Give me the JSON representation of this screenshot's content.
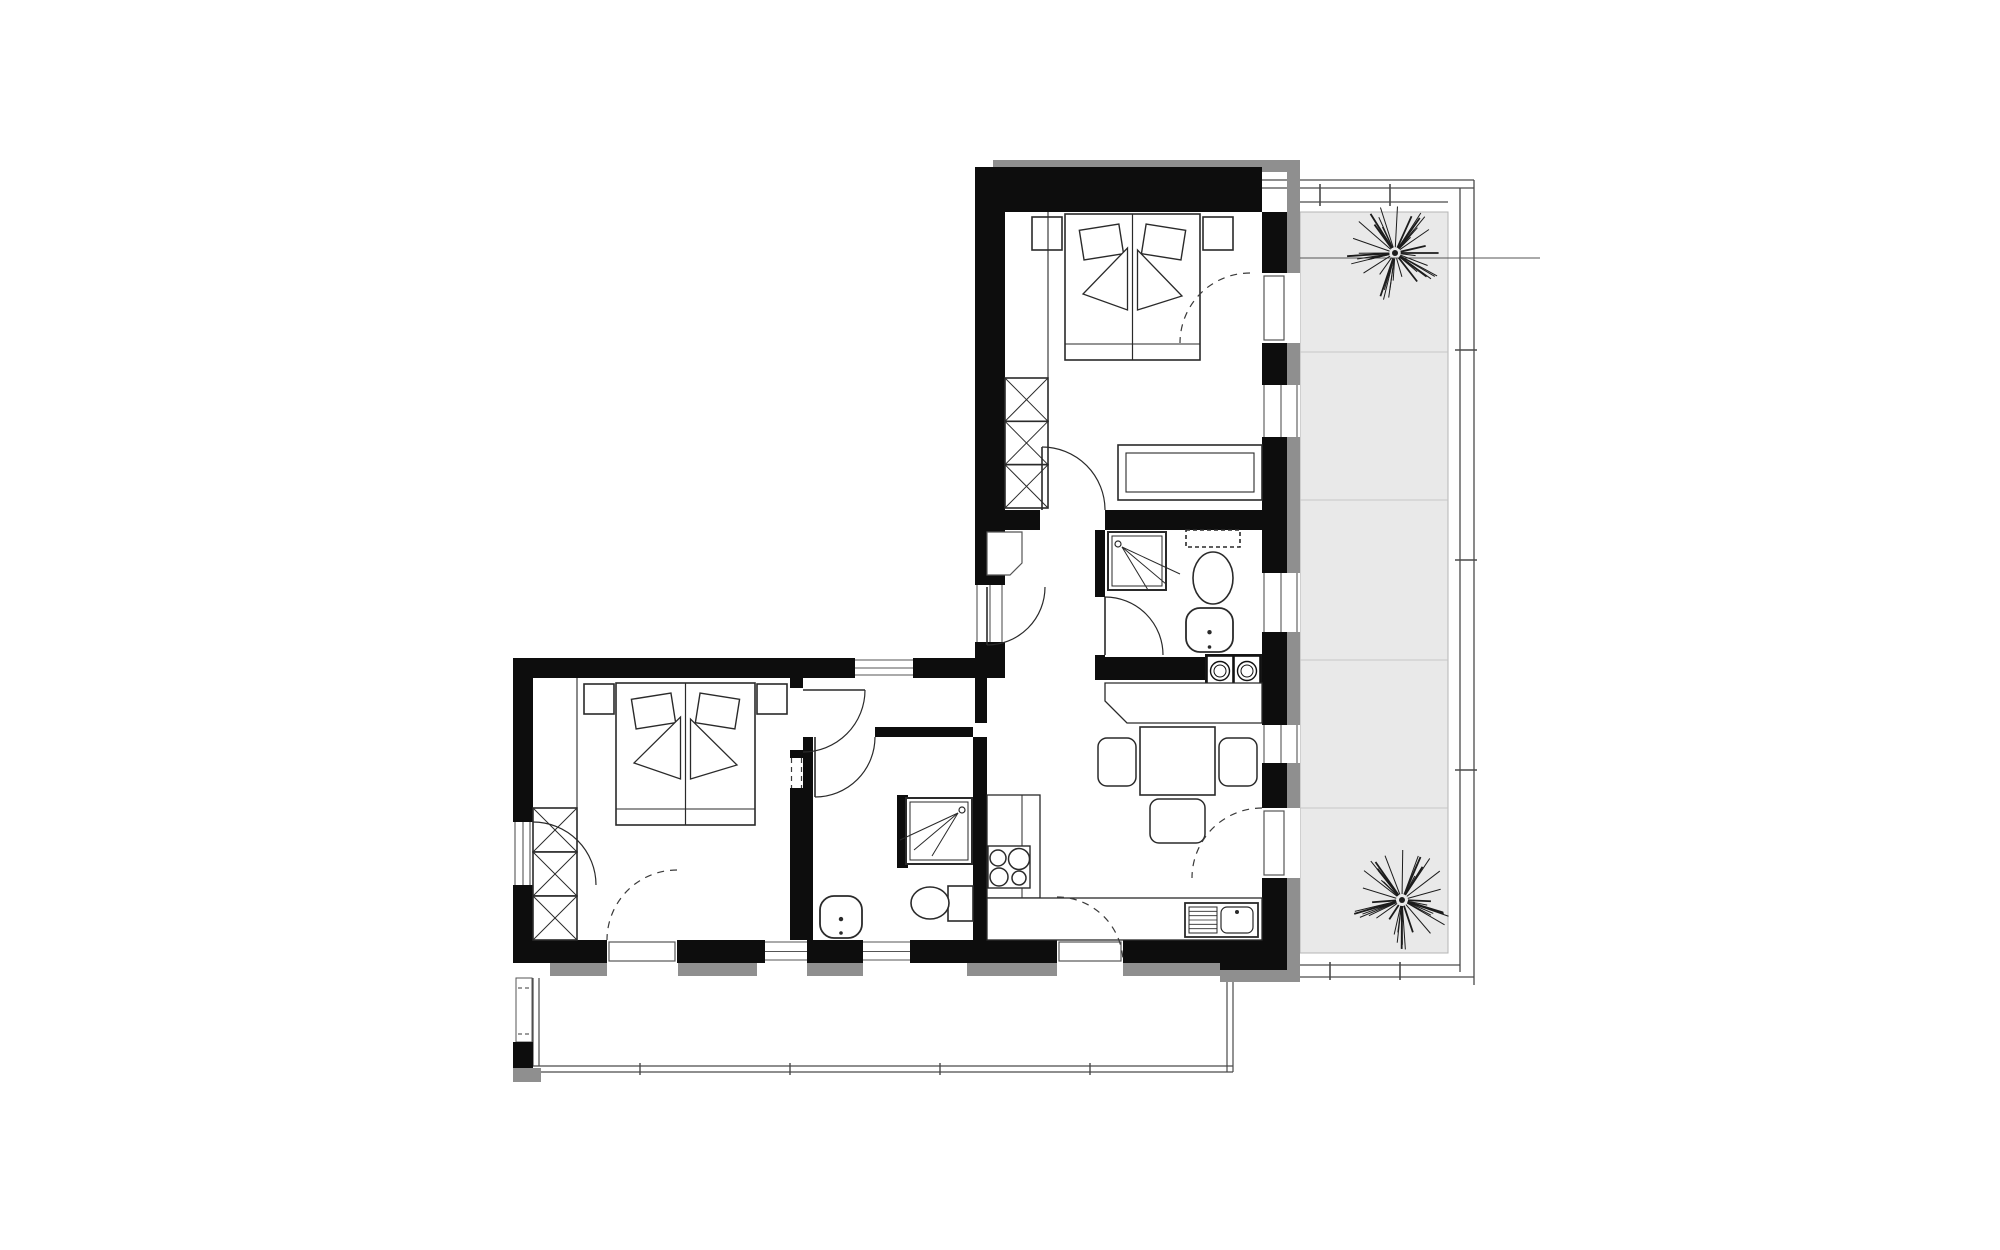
{
  "document": {
    "type": "architectural-floor-plan",
    "text_labels": []
  },
  "palette": {
    "wall": "#0d0d0d",
    "exterior_band": "#8f8f8f",
    "terrace_floor": "#e9e9e9",
    "terrace_tile_line": "#c6c6c6",
    "furniture_line": "#2a2a2a",
    "thin_line": "#555555",
    "dash_line": "#3a3a3a",
    "background": "#ffffff"
  },
  "canvas": {
    "w": 2000,
    "h": 1250
  },
  "terrace": {
    "floor": [
      1300,
      212,
      148,
      741
    ],
    "tile_lines_y": [
      352,
      500,
      660,
      808
    ],
    "railing": [
      [
        1253,
        180,
        1474,
        180
      ],
      [
        1253,
        188,
        1474,
        188
      ],
      [
        1300,
        202,
        1448,
        202
      ],
      [
        1460,
        188,
        1460,
        972
      ],
      [
        1474,
        180,
        1474,
        985
      ],
      [
        1300,
        965,
        1460,
        965
      ],
      [
        1255,
        977,
        1474,
        977
      ]
    ],
    "ticks": [
      [
        1320,
        184,
        1320,
        206
      ],
      [
        1390,
        184,
        1390,
        206
      ],
      [
        1455,
        350,
        1477,
        350
      ],
      [
        1455,
        560,
        1477,
        560
      ],
      [
        1455,
        770,
        1477,
        770
      ],
      [
        1330,
        962,
        1330,
        980
      ],
      [
        1400,
        962,
        1400,
        980
      ]
    ],
    "plant_line": [
      1298,
      258,
      1540,
      258
    ],
    "plants": [
      {
        "name": "terrace-plant-top",
        "cx": 1395,
        "cy": 253,
        "r": 48
      },
      {
        "name": "terrace-plant-bottom",
        "cx": 1402,
        "cy": 900,
        "r": 50
      }
    ]
  },
  "balcony": {
    "lines": [
      [
        533,
        978,
        533,
        1066
      ],
      [
        539,
        978,
        539,
        1066
      ],
      [
        533,
        1066,
        1233,
        1066
      ],
      [
        533,
        1072,
        1233,
        1072
      ],
      [
        1227,
        980,
        1227,
        1072
      ],
      [
        1233,
        980,
        1233,
        1072
      ]
    ],
    "ticks": [
      [
        640,
        1063,
        640,
        1075
      ],
      [
        790,
        1063,
        790,
        1075
      ],
      [
        940,
        1063,
        940,
        1075
      ],
      [
        1090,
        1063,
        1090,
        1075
      ]
    ],
    "corner_window": {
      "rect": [
        516,
        978,
        16,
        64
      ],
      "dashes": [
        [
          518,
          988,
          530,
          988
        ],
        [
          518,
          1034,
          530,
          1034
        ]
      ]
    },
    "parapet_wall": [
      513,
      1042,
      20,
      26
    ],
    "parapet_gray": [
      513,
      1068,
      28,
      14
    ]
  },
  "gray_bands": [
    [
      993,
      160,
      260,
      12
    ],
    [
      1253,
      160,
      47,
      12
    ],
    [
      1287,
      172,
      13,
      101
    ],
    [
      1287,
      343,
      13,
      42
    ],
    [
      1287,
      437,
      13,
      136
    ],
    [
      1287,
      632,
      13,
      93
    ],
    [
      1287,
      763,
      13,
      45
    ],
    [
      1287,
      878,
      13,
      92
    ],
    [
      1220,
      970,
      80,
      12
    ],
    [
      550,
      963,
      57,
      13
    ],
    [
      678,
      963,
      79,
      13
    ],
    [
      807,
      963,
      56,
      13
    ],
    [
      967,
      963,
      90,
      13
    ],
    [
      1123,
      963,
      97,
      13
    ]
  ],
  "walls": [
    [
      975,
      167,
      287,
      45
    ],
    [
      975,
      212,
      30,
      373
    ],
    [
      975,
      642,
      30,
      36
    ],
    [
      975,
      678,
      12,
      45
    ],
    [
      1262,
      212,
      25,
      61
    ],
    [
      1262,
      343,
      25,
      42
    ],
    [
      1262,
      437,
      25,
      136
    ],
    [
      1262,
      632,
      25,
      93
    ],
    [
      1262,
      763,
      25,
      45
    ],
    [
      1262,
      878,
      25,
      62
    ],
    [
      1220,
      940,
      67,
      30
    ],
    [
      975,
      510,
      65,
      20
    ],
    [
      1105,
      510,
      157,
      20
    ],
    [
      1095,
      530,
      10,
      67
    ],
    [
      1095,
      655,
      10,
      25
    ],
    [
      1095,
      657,
      110,
      23
    ],
    [
      513,
      658,
      342,
      20
    ],
    [
      913,
      658,
      62,
      20
    ],
    [
      513,
      658,
      20,
      164
    ],
    [
      513,
      885,
      20,
      55
    ],
    [
      513,
      940,
      94,
      23
    ],
    [
      677,
      940,
      88,
      23
    ],
    [
      807,
      940,
      56,
      23
    ],
    [
      910,
      940,
      147,
      23
    ],
    [
      1123,
      940,
      97,
      23
    ],
    [
      790,
      678,
      13,
      10
    ],
    [
      790,
      750,
      13,
      190
    ],
    [
      803,
      737,
      10,
      203
    ],
    [
      875,
      727,
      98,
      10
    ],
    [
      973,
      737,
      14,
      203
    ],
    [
      897,
      795,
      11,
      73
    ]
  ],
  "windows": [
    {
      "r": [
        1262,
        385,
        38,
        52
      ],
      "dir": "v",
      "kind": "win"
    },
    {
      "r": [
        1262,
        573,
        38,
        59
      ],
      "dir": "v",
      "kind": "win"
    },
    {
      "r": [
        1262,
        725,
        38,
        38
      ],
      "dir": "v",
      "kind": "win"
    },
    {
      "r": [
        1262,
        273,
        38,
        70
      ],
      "dir": "v",
      "kind": "slab"
    },
    {
      "r": [
        1262,
        808,
        38,
        70
      ],
      "dir": "v",
      "kind": "slab"
    },
    {
      "r": [
        855,
        658,
        58,
        20
      ],
      "dir": "h",
      "kind": "win"
    },
    {
      "r": [
        765,
        940,
        42,
        23
      ],
      "dir": "h",
      "kind": "win"
    },
    {
      "r": [
        863,
        940,
        47,
        23
      ],
      "dir": "h",
      "kind": "win"
    },
    {
      "r": [
        607,
        940,
        70,
        23
      ],
      "dir": "h",
      "kind": "slab"
    },
    {
      "r": [
        1057,
        940,
        66,
        23
      ],
      "dir": "h",
      "kind": "slab"
    },
    {
      "r": [
        975,
        585,
        30,
        57
      ],
      "dir": "v",
      "kind": "entry"
    },
    {
      "r": [
        513,
        822,
        20,
        63
      ],
      "dir": "v",
      "kind": "win"
    },
    {
      "r": [
        790,
        758,
        13,
        30
      ],
      "dir": "v",
      "kind": "dash"
    }
  ],
  "doors": [
    {
      "name": "entry-door",
      "h": [
        987,
        587
      ],
      "r": 58,
      "a1": 90,
      "a2": 0,
      "sw": 0,
      "leaf": [
        987,
        587,
        987,
        645
      ]
    },
    {
      "name": "bedroom-1-door",
      "h": [
        1042,
        510
      ],
      "r": 63,
      "a1": -90,
      "a2": 0,
      "sw": 1,
      "leaf": [
        1042,
        510,
        1042,
        447
      ]
    },
    {
      "name": "bathroom-1-door",
      "h": [
        1105,
        655
      ],
      "r": 58,
      "a1": -90,
      "a2": 0,
      "sw": 1,
      "leaf": [
        1105,
        655,
        1105,
        597
      ]
    },
    {
      "name": "bedroom-1-terrace-door",
      "h": [
        1250,
        343
      ],
      "r": 70,
      "a1": -90,
      "a2": 180,
      "sw": 0,
      "dash": true
    },
    {
      "name": "living-terrace-door",
      "h": [
        1262,
        878
      ],
      "r": 70,
      "a1": -90,
      "a2": 180,
      "sw": 0,
      "dash": true
    },
    {
      "name": "bedroom-2-balcony-door",
      "h": [
        677,
        940
      ],
      "r": 70,
      "a1": -90,
      "a2": 180,
      "sw": 0,
      "dash": true
    },
    {
      "name": "living-balcony-door",
      "h": [
        1057,
        963
      ],
      "r": 66,
      "a1": -90,
      "a2": 0,
      "sw": 1,
      "dash": true
    },
    {
      "name": "bedroom-2-door",
      "h": [
        803,
        690
      ],
      "r": 62,
      "a1": 0,
      "a2": 90,
      "sw": 1,
      "leaf": [
        803,
        690,
        865,
        690
      ]
    },
    {
      "name": "bathroom-2-door",
      "h": [
        815,
        737
      ],
      "r": 60,
      "a1": 0,
      "a2": 90,
      "sw": 1,
      "leaf": [
        815,
        737,
        815,
        797
      ]
    },
    {
      "name": "bedroom-2-window-casement",
      "h": [
        533,
        885
      ],
      "r": 63,
      "a1": -90,
      "a2": 0,
      "sw": 1
    }
  ],
  "furniture": {
    "beds": [
      {
        "name": "bed-1",
        "r": [
          1065,
          214,
          135,
          146
        ]
      },
      {
        "name": "bed-2",
        "r": [
          616,
          683,
          139,
          142
        ]
      }
    ],
    "nightstands": [
      [
        1032,
        217,
        30,
        33
      ],
      [
        1203,
        217,
        30,
        33
      ],
      [
        584,
        684,
        30,
        30
      ],
      [
        757,
        684,
        30,
        30
      ]
    ],
    "wardrobes": [
      {
        "name": "wardrobe-1",
        "r": [
          1005,
          378,
          43,
          130
        ],
        "cells": 3
      },
      {
        "name": "wardrobe-2",
        "r": [
          533,
          808,
          44,
          132
        ],
        "cells": 3
      }
    ],
    "bench": {
      "outer": [
        1118,
        445,
        144,
        55
      ],
      "inner": [
        1126,
        453,
        128,
        39
      ]
    },
    "lines": [
      [
        1048,
        212,
        1048,
        378
      ],
      [
        577,
        678,
        577,
        808
      ]
    ],
    "showers": [
      {
        "name": "shower-1",
        "r": [
          1108,
          532,
          58,
          58
        ],
        "corner": "tl"
      },
      {
        "name": "shower-2",
        "r": [
          906,
          798,
          66,
          66
        ],
        "corner": "tr"
      }
    ],
    "toilets": [
      {
        "name": "toilet-1",
        "tank": [
          1186,
          530,
          54,
          17
        ],
        "tank_dashed": true,
        "bowl": [
          1213,
          578,
          20,
          26
        ]
      },
      {
        "name": "toilet-2",
        "tank": [
          948,
          886,
          25,
          35
        ],
        "bowl": [
          930,
          903,
          19,
          16
        ]
      }
    ],
    "sinks": [
      {
        "name": "sink-1",
        "r": [
          1186,
          608,
          47,
          44
        ]
      },
      {
        "name": "sink-2",
        "r": [
          820,
          896,
          42,
          42
        ]
      }
    ],
    "washer": {
      "block": [
        1205,
        654,
        57,
        34
      ],
      "units": [
        [
          1207,
          656,
          26,
          30
        ],
        [
          1234,
          656,
          26,
          30
        ]
      ]
    },
    "counters": {
      "kitchenette": [
        [
          1105,
          683
        ],
        [
          1262,
          683
        ],
        [
          1262,
          723
        ],
        [
          1127,
          723
        ],
        [
          1105,
          701
        ]
      ],
      "side": [
        987,
        795,
        53,
        103
      ],
      "side_line": [
        1022,
        795,
        1022,
        898
      ],
      "bottom": [
        987,
        898,
        275,
        42
      ]
    },
    "hob": {
      "frame": [
        988,
        846,
        42,
        42
      ],
      "burners": [
        [
          998,
          858,
          8
        ],
        [
          1019,
          859,
          10.5
        ],
        [
          999,
          877,
          9
        ],
        [
          1019,
          878,
          7
        ]
      ]
    },
    "kitchen_sink": {
      "outer": [
        1185,
        903,
        73,
        34
      ],
      "drainer": [
        1189,
        907,
        28,
        26
      ],
      "basin": [
        1221,
        907,
        32,
        26
      ],
      "tap": [
        1237,
        912
      ]
    },
    "table": [
      1140,
      727,
      75,
      68
    ],
    "chairs": [
      [
        1098,
        738,
        38,
        48
      ],
      [
        1219,
        738,
        38,
        48
      ],
      [
        1150,
        799,
        55,
        44
      ]
    ],
    "niche": [
      [
        987,
        532
      ],
      [
        1022,
        532
      ],
      [
        1022,
        563
      ],
      [
        1010,
        575
      ],
      [
        987,
        575
      ]
    ]
  }
}
